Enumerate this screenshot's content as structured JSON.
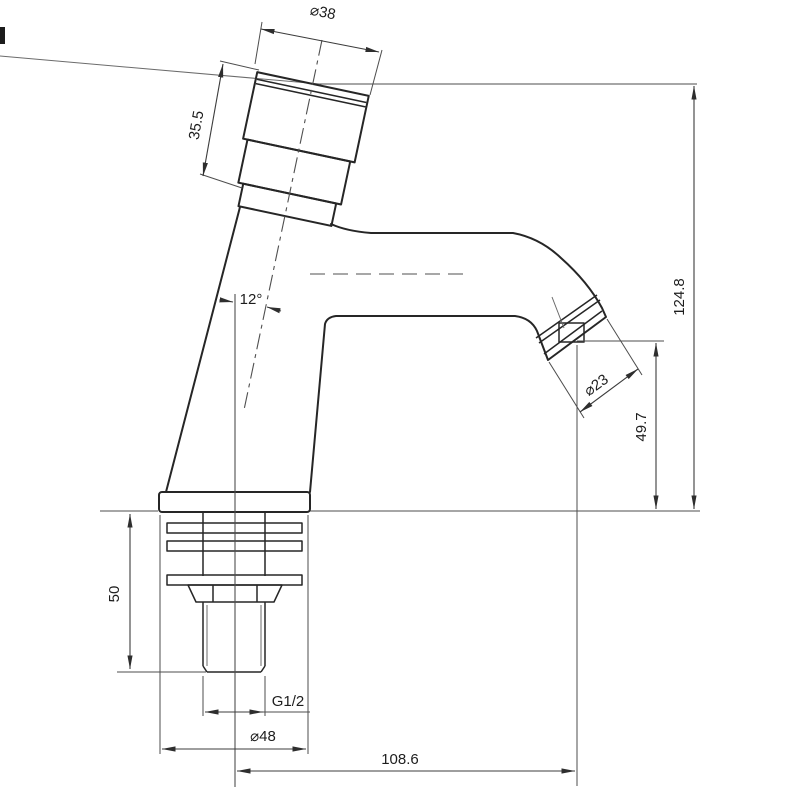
{
  "drawing": {
    "title": "Pillar tap faucet — dimensioned technical drawing",
    "view": "side elevation",
    "dimensions": {
      "handle_diameter": "⌀38",
      "handle_height": "35.5",
      "handle_tilt_angle": "12°",
      "overall_height": "124.8",
      "outlet_height": "49.7",
      "outlet_diameter": "⌀23",
      "shank_length": "50",
      "thread_spec": "G1/2",
      "base_diameter": "⌀48",
      "spout_reach": "108.6"
    },
    "colors": {
      "outline": "#262626",
      "dimension_lines": "#3c3c3c",
      "background": "#ffffff"
    }
  }
}
